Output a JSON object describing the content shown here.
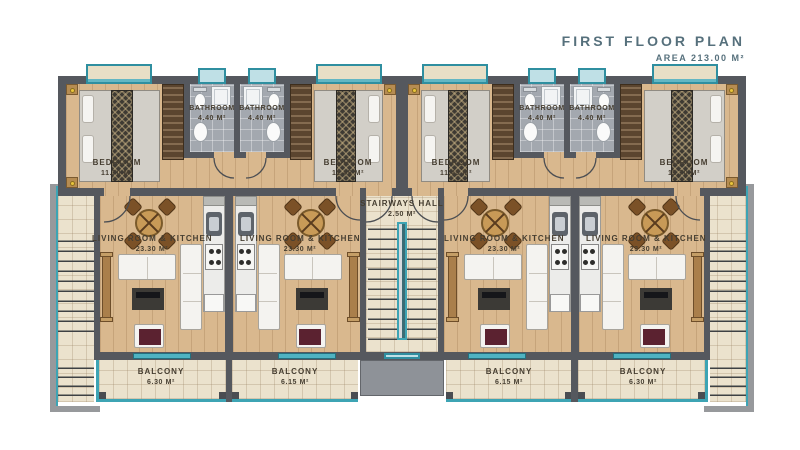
{
  "title": {
    "heading": "First Floor Plan",
    "area_label": "Area 213.00 m²"
  },
  "hall": {
    "name": "Stairways Hall",
    "area": "2.50 m²"
  },
  "units": [
    {
      "bedroom_name": "Bedroom",
      "bedroom_area": "11.70 m²",
      "bathroom_name": "Bathroom",
      "bathroom_area": "4.40 m²",
      "living_name": "Living Room & Kitchen",
      "living_area": "23.30 m²",
      "balcony_name": "Balcony",
      "balcony_area": "6.30 m²"
    },
    {
      "bedroom_name": "Bedroom",
      "bedroom_area": "11.45 m²",
      "bathroom_name": "Bathroom",
      "bathroom_area": "4.40 m²",
      "living_name": "Living Room & Kitchen",
      "living_area": "23.30 m²",
      "balcony_name": "Balcony",
      "balcony_area": "6.15 m²"
    },
    {
      "bedroom_name": "Bedroom",
      "bedroom_area": "11.45 m²",
      "bathroom_name": "Bathroom",
      "bathroom_area": "4.40 m²",
      "living_name": "Living Room & Kitchen",
      "living_area": "23.30 m²",
      "balcony_name": "Balcony",
      "balcony_area": "6.15 m²"
    },
    {
      "bedroom_name": "Bedroom",
      "bedroom_area": "11.70 m²",
      "bathroom_name": "Bathroom",
      "bathroom_area": "4.40 m²",
      "living_name": "Living Room & Kitchen",
      "living_area": "23.30 m²",
      "balcony_name": "Balcony",
      "balcony_area": "6.30 m²"
    }
  ],
  "colors": {
    "accent_teal": "#3da4b4",
    "wall_gray": "#55585e",
    "wood_floor": "#d9b88e",
    "tile_beige": "#ebe2cd",
    "tile_gray": "#a3a8af",
    "label_text": "#463e31",
    "title_text": "#56707c"
  }
}
